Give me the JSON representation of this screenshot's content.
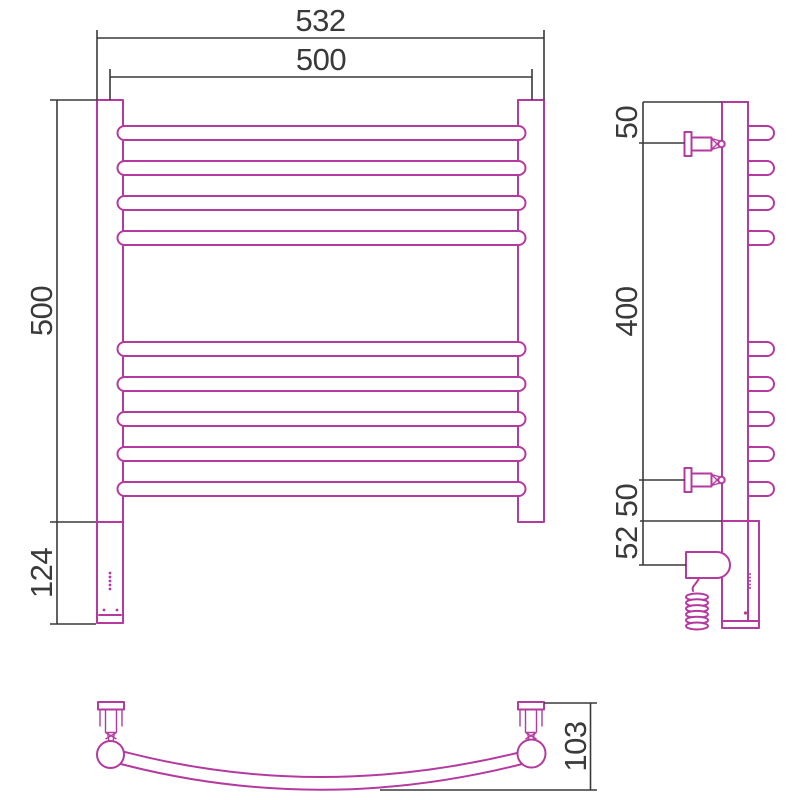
{
  "drawing": {
    "title": "heated-towel-rail-technical-drawing",
    "colors": {
      "outline": "#b53aa0",
      "dimension": "#3a3a3a",
      "background": "#ffffff"
    },
    "front_view": {
      "overall_width_mm": "532",
      "rail_width_mm": "500",
      "rail_height_mm": "500",
      "heater_section_height_mm": "124"
    },
    "side_view": {
      "top_bracket_offset_mm": "50",
      "bracket_spacing_mm": "400",
      "bottom_bracket_offset_mm": "50",
      "heater_drop_mm": "52"
    },
    "bottom_view": {
      "depth_mm": "103"
    }
  }
}
